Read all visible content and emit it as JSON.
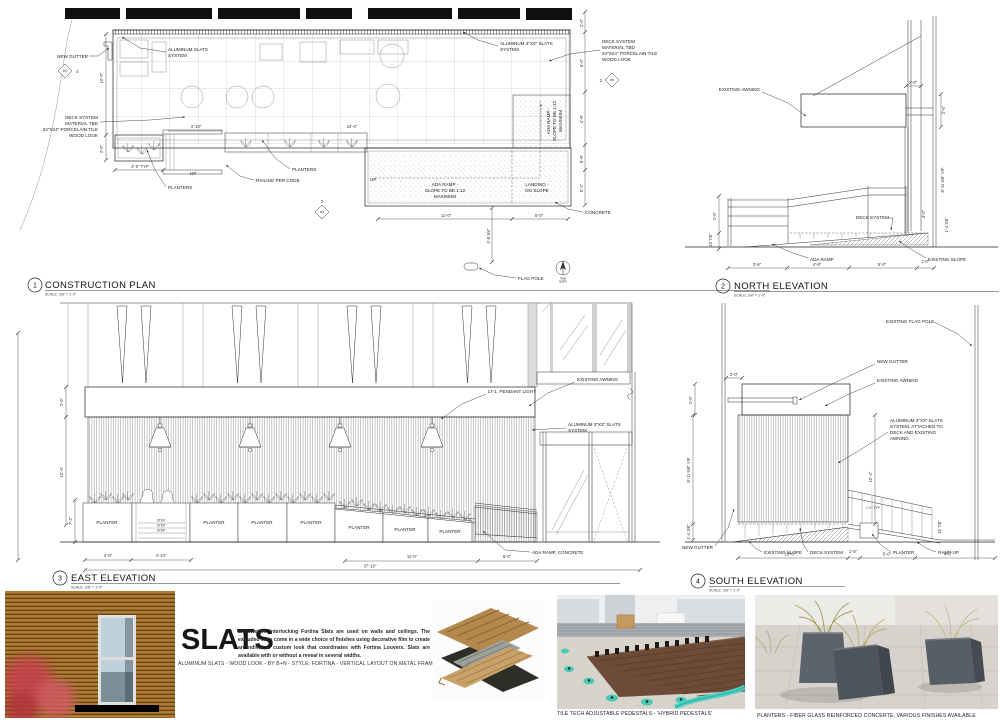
{
  "plan": {
    "num": "1",
    "title": "CONSTRUCTION PLAN",
    "scale": "SCALE: 3/8\" = 1'-0\"",
    "labels": {
      "new_gutter": "NEW GUTTER",
      "alum_slats": [
        "ALUMINUM SLATS",
        "SYSTEM"
      ],
      "deck_note": [
        "DECK SYSTEM",
        "MATERIAL TBD",
        "24\"X24\" PORCELAIN TILE",
        "WOOD LOOK"
      ],
      "alum_3x3": [
        "ALUMINUM 3\"X3\" SLATS",
        "SYSTEM"
      ],
      "planters": "PLANTERS",
      "railing": "RAILING PER CODE",
      "up": "UP",
      "ada_ramp": [
        "ADA RAMP -",
        "SLOPE TO BE 1:12",
        "MAXIMUM"
      ],
      "landing": [
        "LANDING -",
        "NO SLOPE"
      ],
      "concrete": "CONCRETE",
      "flag_pole": "FLAG POLE",
      "true_north": [
        "TRUE",
        "NORTH"
      ],
      "pp1": "PP1"
    },
    "dims": {
      "left_v": [
        "10'-0\"",
        "2'-0\""
      ],
      "bottom": [
        "4'-9\" TYP",
        "4'-10\"",
        "24'-0\"",
        "11'-0\"",
        "5'-0\"",
        "4'-8 3/4\""
      ],
      "right_v": [
        "2'-0\"",
        "5'-0\"",
        "4'-9\"",
        "9'-9\"",
        "5'-2\""
      ]
    },
    "markers": {
      "m4": "4",
      "m2": "2",
      "m3": "3"
    }
  },
  "north": {
    "num": "2",
    "title": "NORTH ELEVATION",
    "scale": "SCALE: 3/8\" = 1'-0\"",
    "labels": {
      "existing_awning": "EXISTING AWNING",
      "deck_system": "DECK SYSTEM",
      "ada_ramp": "ADA RAMP",
      "existing_slope": "EXISTING SLOPE"
    },
    "dims": {
      "top": "2'-0\"",
      "awning_h": "2'-6\"",
      "left": [
        "2'-6\"",
        "10 7/8\""
      ],
      "right": [
        "8'-11 5/8\" VIF",
        "3'-0\"",
        "1'-4 3/8\""
      ],
      "bottom": [
        "3'-6\"",
        "4'-9\"",
        "5'-0\"",
        "1'-0\""
      ]
    }
  },
  "east": {
    "num": "3",
    "title": "EAST ELEVATION",
    "scale": "SCALE: 3/8\" = 1'-0\"",
    "labels": {
      "existing_awning": "EXISTING AWNING",
      "pendant": "LT-1, PENDANT LIGHT",
      "alum_3x3": [
        "ALUMINUM 3\"X3\" SLATS",
        "SYSTEM"
      ],
      "ada_ramp": "ADA RAMP, CONCRETE",
      "planter": "PLANTER",
      "step": "STEP"
    },
    "dims": {
      "left": [
        "2'-6\"",
        "10'-4\"",
        "7'-2\""
      ],
      "bottom1": [
        "4'-0\"",
        "4'-10\"",
        "11'-0\"",
        "5'-0\""
      ],
      "bottom2": "37'-10\""
    }
  },
  "south": {
    "num": "4",
    "title": "SOUTH ELEVATION",
    "scale": "SCALE: 3/8\" = 1'-0\"",
    "labels": {
      "flag_pole": "EXISTING FLAG POLE",
      "new_gutter": "NEW GUTTER",
      "existing_awning": "EXISTING AWNING",
      "alum_3x3": [
        "ALUMINUM 3\"X3\" SLATS",
        "SYSTEM, ATTACHED TO",
        "DECK AND EXISTING",
        "AWNING"
      ],
      "new_gutter2": "NEW GUTTER",
      "existing_slope": "EXISTING SLOPE",
      "deck_system": "DECK SYSTEM",
      "planter": "PLANTER",
      "ramp_up": "RAMP UP",
      "rail_typ": "1'-0\" TYP"
    },
    "dims": {
      "top": "2'-0\"",
      "awning_h": "2'-6\"",
      "left": [
        "8'-11 5/8\" VIF",
        "1'-4 3/8\""
      ],
      "right": [
        "10'-4\"",
        "10 7/8\""
      ],
      "bottom": [
        "10'-0\"",
        "1'-0\"",
        "5'-0\"",
        "4'-6\""
      ]
    }
  },
  "products": {
    "slats": {
      "heading": "SLATS",
      "paragraph": "Lightweight interlocking Fortina Slats are used on walls and ceilings. The extruded slats come in a wide choice of finishes using decorative film to create an individual custom look that coordinates with Fortina Louvers. Slats are available with or without a reveal in several widths.",
      "caption": "ALUMINUM SLATS - WOOD LOOK - BY B+N - STYLE: FORTINA - VERTICAL LAYOUT ON METAL FRAMES"
    },
    "tile": {
      "caption": "TILE TECH ADJUSTABLE PEDESTALS - 'HYBRID PEDESTALS'"
    },
    "planters": {
      "caption": "PLANTERS - FIBER GLASS REINFORCED CONCERTE, VARIOUS FINISHES AVAILABLE"
    }
  }
}
